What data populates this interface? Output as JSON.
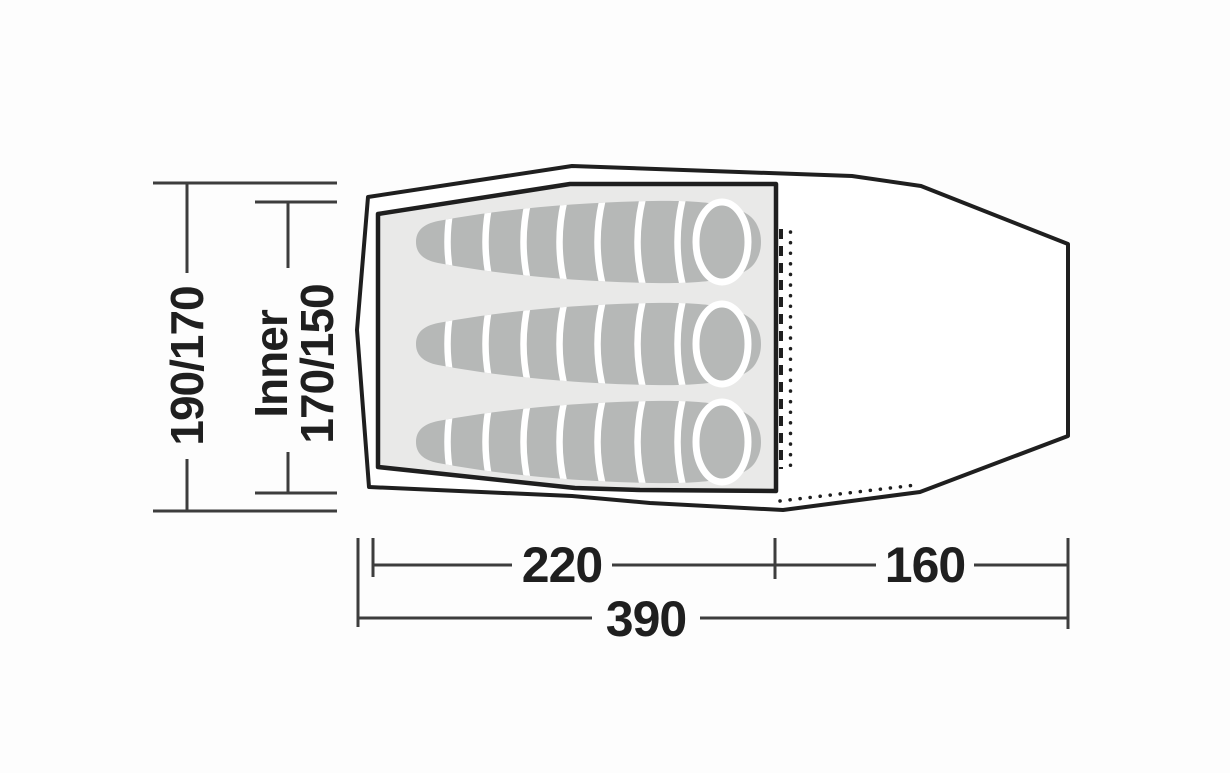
{
  "diagram": {
    "kind": "tent-floorplan",
    "labels": {
      "flysheet_depth": "190/170",
      "inner_prefix": "Inner",
      "inner_depth": "170/150",
      "inner_length": "220",
      "porch_length": "160",
      "total_length": "390"
    },
    "dimensions": {
      "flysheet_depth": "190/170",
      "inner_depth": "170/150",
      "inner_length": 220,
      "porch_length": 160,
      "total_length": 390
    },
    "features": {
      "sleeping_bag_count": 3
    },
    "colors": {
      "outline": "#1f1f1f",
      "inner_fill": "#e9e9e8",
      "sleeping_bag_fill": "#b6b8b7",
      "divider": "#ffffff",
      "dimension_line": "#3d3d3d",
      "text": "#1f1f1f",
      "background": "#fdfdfd"
    }
  }
}
